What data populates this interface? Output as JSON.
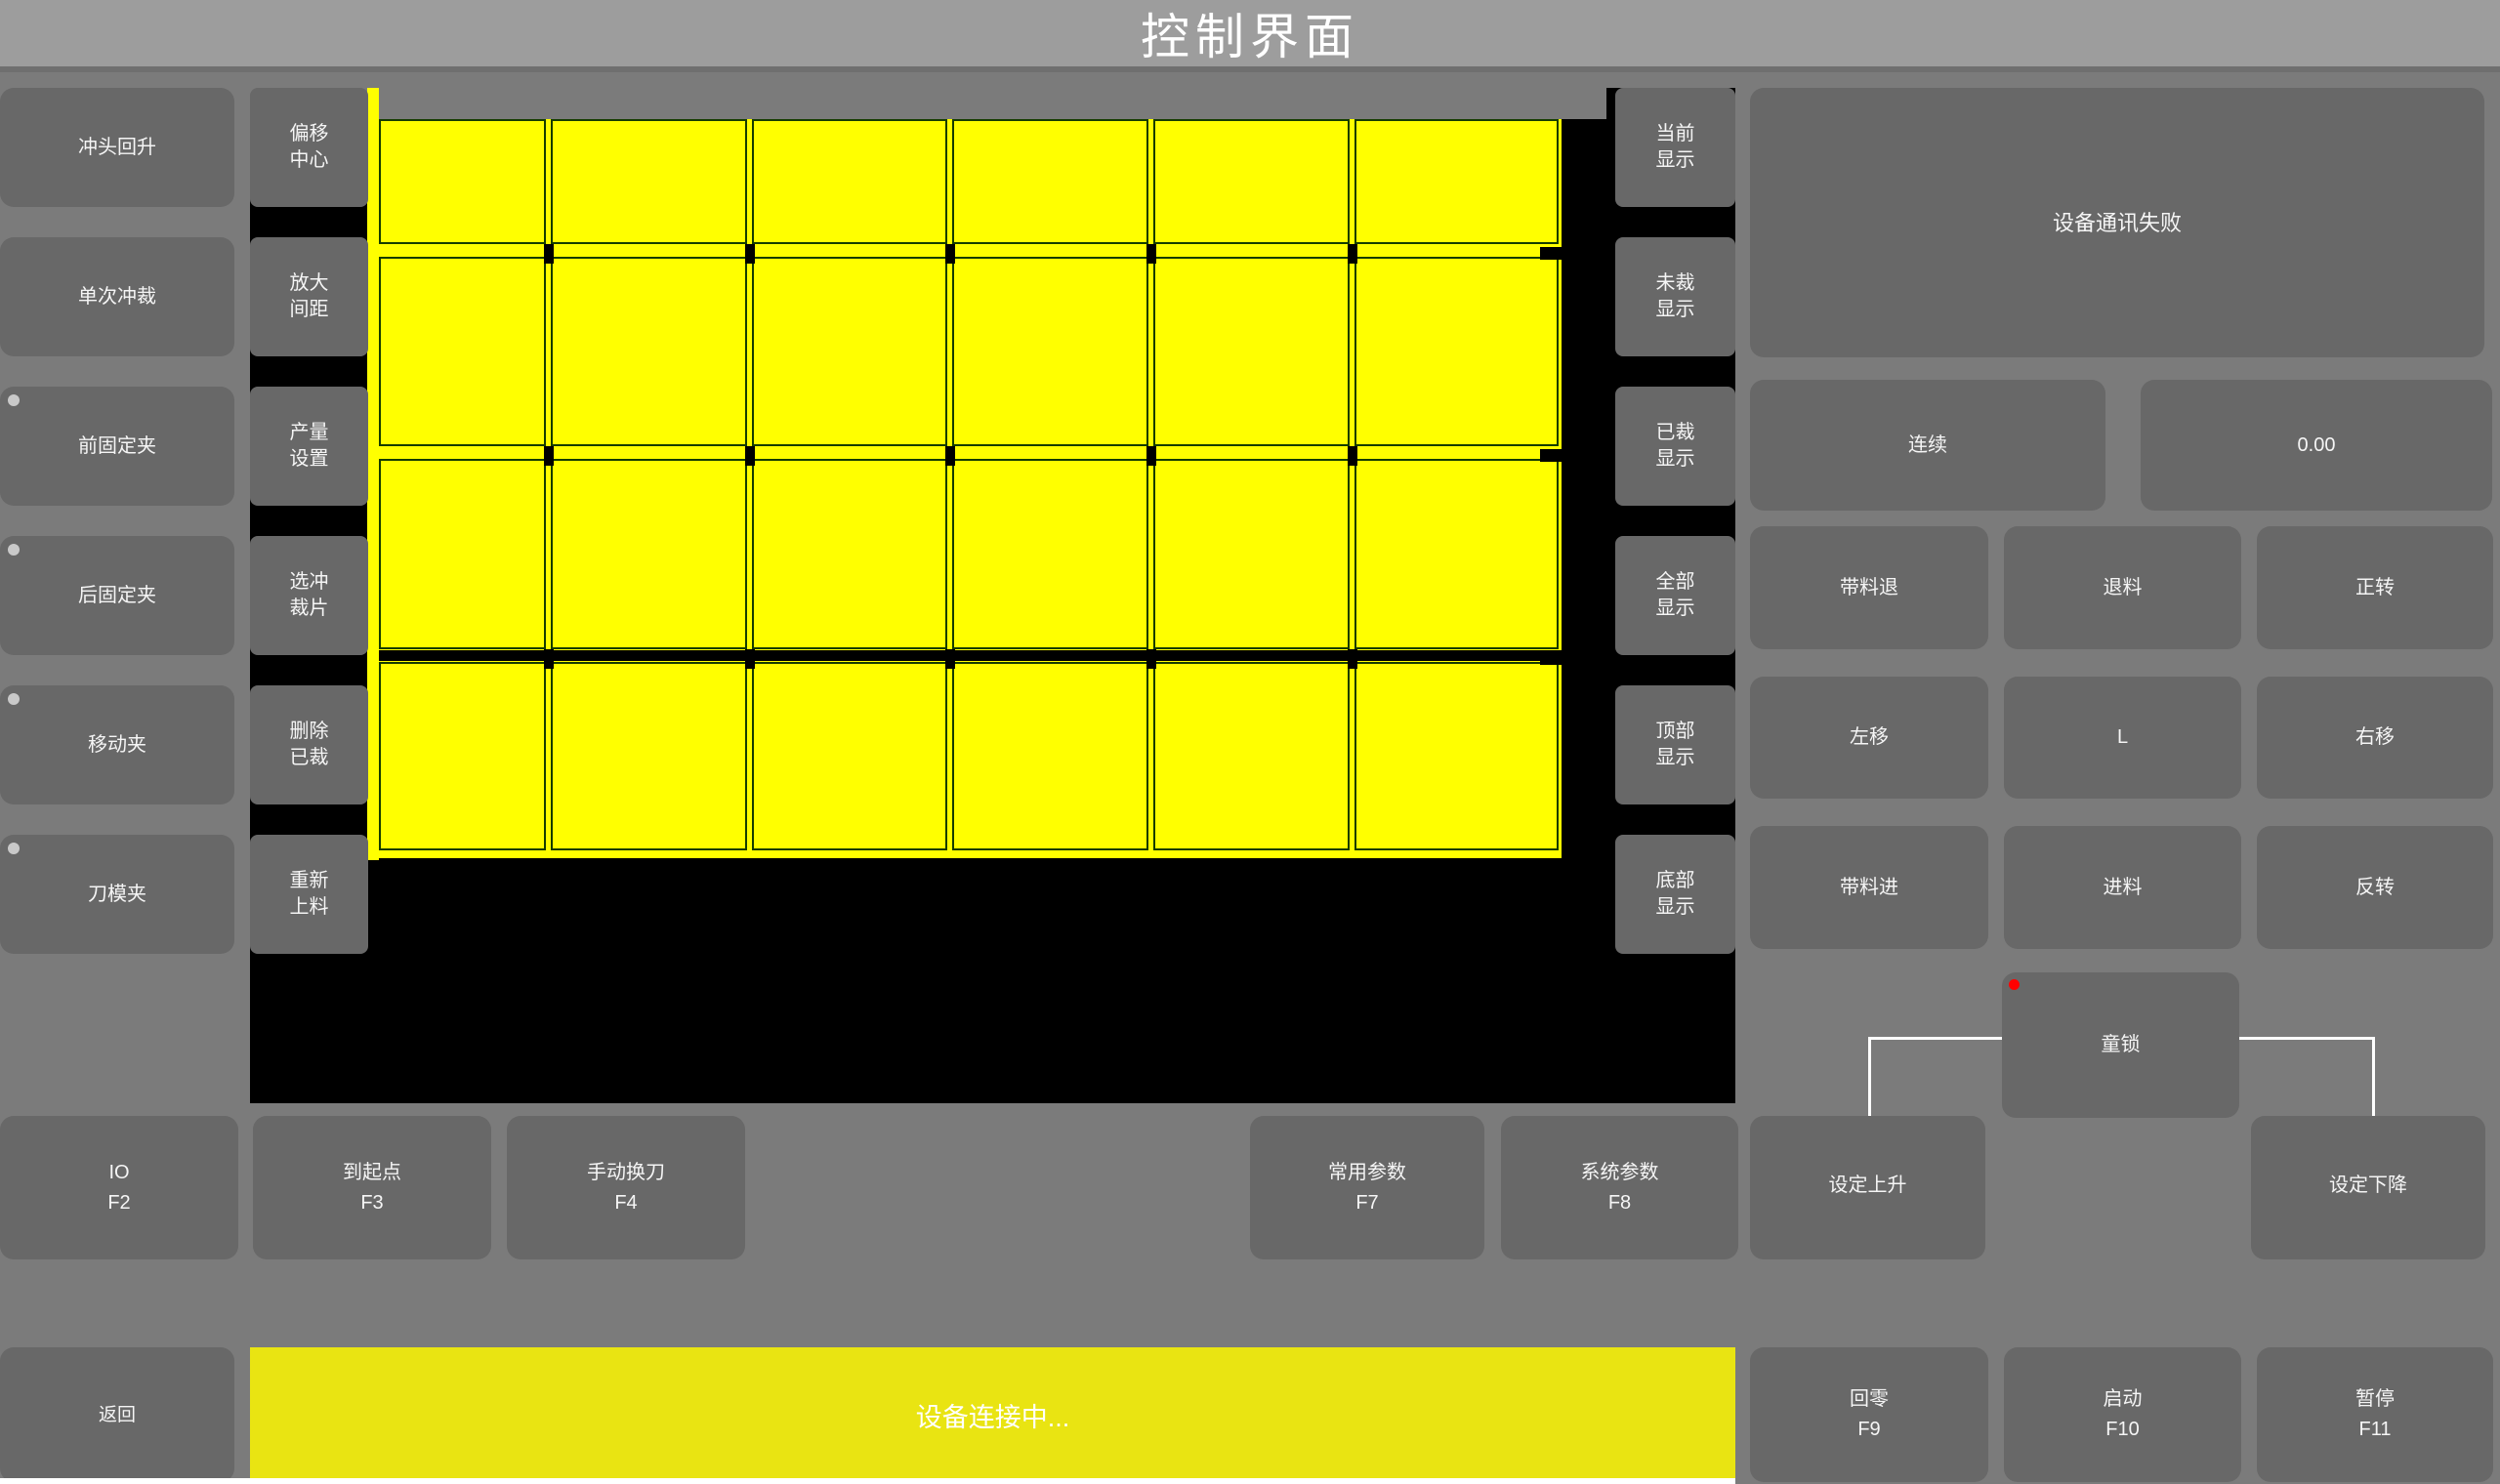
{
  "title": "控制界面",
  "left_column": {
    "items": [
      {
        "label": "冲头回升",
        "dot": false
      },
      {
        "label": "单次冲裁",
        "dot": false
      },
      {
        "label": "前固定夹",
        "dot": true
      },
      {
        "label": "后固定夹",
        "dot": true
      },
      {
        "label": "移动夹",
        "dot": true
      },
      {
        "label": "刀模夹",
        "dot": true
      }
    ]
  },
  "tool_column": {
    "items": [
      {
        "label": "偏移\n中心"
      },
      {
        "label": "放大\n间距"
      },
      {
        "label": "产量\n设置"
      },
      {
        "label": "选冲\n裁片"
      },
      {
        "label": "删除\n已裁"
      },
      {
        "label": "重新\n上料"
      }
    ]
  },
  "display_column": {
    "items": [
      {
        "label": "当前\n显示"
      },
      {
        "label": "未裁\n显示"
      },
      {
        "label": "已裁\n显示"
      },
      {
        "label": "全部\n显示"
      },
      {
        "label": "顶部\n显示"
      },
      {
        "label": "底部\n显示"
      }
    ]
  },
  "right_panel": {
    "message": "设备通讯失败",
    "mode_button": "连续",
    "value_display": "0.00",
    "jog_grid": {
      "rows": [
        [
          "带料退",
          "退料",
          "正转"
        ],
        [
          "左移",
          "L",
          "右移"
        ],
        [
          "带料进",
          "进料",
          "反转"
        ]
      ]
    },
    "child_lock": {
      "label": "童锁",
      "indicator_color": "#ff0000"
    }
  },
  "function_row": {
    "items": [
      {
        "label": "IO",
        "key": "F2"
      },
      {
        "label": "到起点",
        "key": "F3"
      },
      {
        "label": "手动换刀",
        "key": "F4"
      },
      {
        "label": "常用参数",
        "key": "F7"
      },
      {
        "label": "系统参数",
        "key": "F8"
      },
      {
        "label": "设定上升",
        "key": ""
      },
      {
        "label": "设定下降",
        "key": ""
      }
    ]
  },
  "bottom_bar": {
    "back_label": "返回",
    "status_text": "设备连接中...",
    "status_color": "#e9e412",
    "buttons": [
      {
        "label": "回零",
        "key": "F9"
      },
      {
        "label": "启动",
        "key": "F10"
      },
      {
        "label": "暂停",
        "key": "F11"
      }
    ]
  },
  "canvas": {
    "sheet_color": "#ffff00",
    "line_color": "#153c00",
    "mark_color": "#000000",
    "columns": 6,
    "rows": 4,
    "col_edges": [
      388,
      562,
      768,
      973,
      1179,
      1385,
      1599
    ],
    "row_edges": [
      122,
      258,
      465,
      673,
      879
    ],
    "thick_separator_row": 3
  }
}
